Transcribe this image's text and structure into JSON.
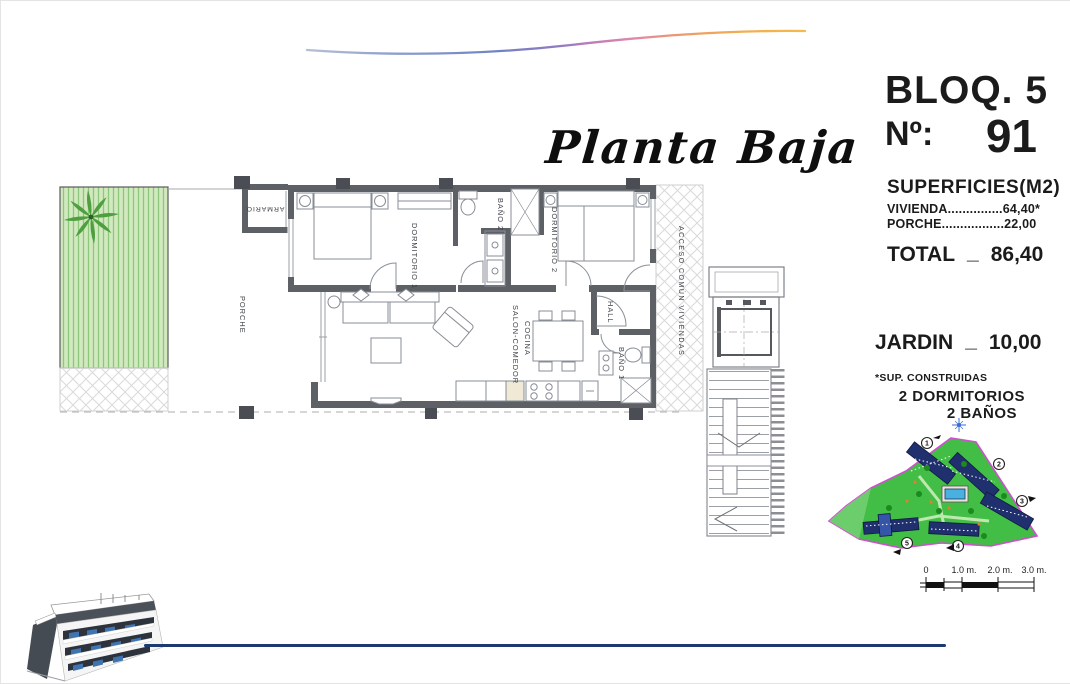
{
  "header": {
    "title": "Planta Baja"
  },
  "info_panel": {
    "block_label": "BLOQ. 5",
    "unit_label": "Nº:",
    "unit_value": "91",
    "surfaces_title": "SUPERFICIES(M2)",
    "vivienda_line": "VIVIENDA...............64,40*",
    "porche_line": "PORCHE.................22,00",
    "total_label": "TOTAL",
    "total_sep": "_",
    "total_value": "86,40",
    "jardin_label": "JARDIN",
    "jardin_sep": "_",
    "jardin_value": "10,00",
    "footnote": "*SUP. CONSTRUIDAS",
    "features": [
      "2 DORMITORIOS",
      "2 BAÑOS"
    ]
  },
  "floor_plan": {
    "labels": {
      "porche": "PORCHE",
      "armario": "ARMARIO",
      "dormitorio1": "DORMITORIO 1",
      "bano2": "BAÑO 2",
      "dormitorio2": "DORMITORIO 2",
      "hall": "HALL",
      "salon_line1": "SALON-COMEDOR",
      "salon_line2": "COCINA",
      "bano1": "BAÑO 1",
      "acceso": "ACCESO COMÚN VIVIENDAS"
    }
  },
  "site_plan": {
    "markers": [
      "1",
      "2",
      "3",
      "4",
      "5"
    ]
  },
  "scale_bar": {
    "ticks": [
      "0",
      "1.0 m.",
      "2.0 m.",
      "3.0 m."
    ]
  },
  "colors": {
    "wave_blue": "#7183c4",
    "wave_purple": "#8f7ac2",
    "wave_pink": "#e288a6",
    "wave_orange": "#f5ba4a",
    "bottom_line_blue": "#1d3a6f",
    "garden_green": "#d2e9c0",
    "garden_stripe": "#8cc87c",
    "site_green": "#42bd45",
    "site_border_magenta": "#cf4fcf",
    "building_navy": "#20306e",
    "pool_blue": "#49b0e0",
    "wall_gray": "#5d6166"
  }
}
